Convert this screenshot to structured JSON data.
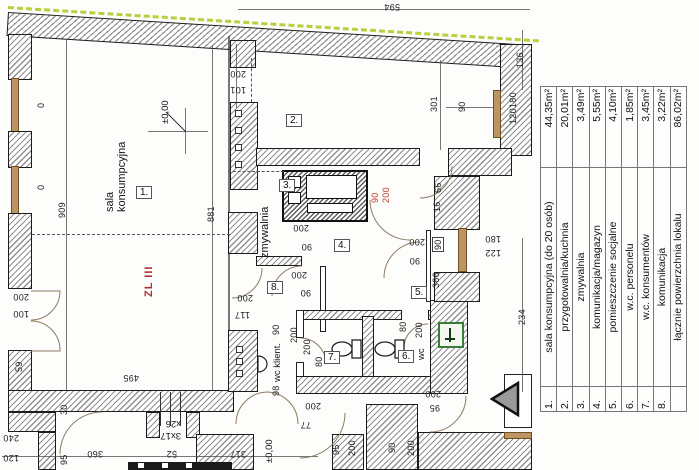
{
  "colors": {
    "boundary_cyan": "#35bfdc",
    "boundary_green": "#b9cf3e",
    "new_element_red": "#c03b2d",
    "window_tan": "#bd9466"
  },
  "legend": {
    "rows": [
      {
        "no": "1.",
        "name": "sala konsumpcyjna (do 20 osób)",
        "area": "44,35m²"
      },
      {
        "no": "2.",
        "name": "przygotowalnia/kuchnia",
        "area": "20,01m²"
      },
      {
        "no": "3.",
        "name": "zmywalnia",
        "area": "3,49m²"
      },
      {
        "no": "4.",
        "name": "komunikacja/magazyn",
        "area": "5,55m²"
      },
      {
        "no": "5.",
        "name": "pomieszczenie socjalne",
        "area": "4,10m²"
      },
      {
        "no": "6.",
        "name": "w.c. personelu",
        "area": "1,85m²"
      },
      {
        "no": "7.",
        "name": "w.c. konsumentów",
        "area": "3,45m²"
      },
      {
        "no": "8.",
        "name": "komunikacja",
        "area": "3,22m²"
      },
      {
        "no": "",
        "name": "łącznie powierzchnia lokalu",
        "area": "86,02m²"
      }
    ]
  },
  "room_numbers": [
    {
      "no": "1.",
      "x": 136,
      "y": 186
    },
    {
      "no": "2.",
      "x": 286,
      "y": 114
    },
    {
      "no": "3.",
      "x": 279,
      "y": 179
    },
    {
      "no": "4.",
      "x": 334,
      "y": 239
    },
    {
      "no": "5.",
      "x": 411,
      "y": 286
    },
    {
      "no": "6.",
      "x": 398,
      "y": 350
    },
    {
      "no": "7.",
      "x": 324,
      "y": 351
    },
    {
      "no": "8.",
      "x": 267,
      "y": 281
    }
  ],
  "texts": [
    {
      "t": "sala\nkonsumpcyjna",
      "x": 104,
      "y": 212,
      "r": -90,
      "c": "room"
    },
    {
      "t": "zmywalnia",
      "x": 259,
      "y": 258,
      "r": -90,
      "c": "room"
    },
    {
      "t": "wc",
      "x": 416,
      "y": 360,
      "r": -90,
      "c": "small"
    },
    {
      "t": "wc klient.",
      "x": 272,
      "y": 382,
      "r": -90,
      "c": "small"
    },
    {
      "t": "ZL III",
      "x": 143,
      "y": 297,
      "r": -90,
      "c": "fire"
    },
    {
      "t": "±0,00",
      "x": 160,
      "y": 124,
      "r": -90,
      "c": "small"
    },
    {
      "t": "±0,00",
      "x": 264,
      "y": 463,
      "r": -90,
      "c": "small"
    },
    {
      "t": "x26",
      "x": 181,
      "y": 429,
      "r": 180,
      "c": "small"
    },
    {
      "t": "3x17",
      "x": 181,
      "y": 441,
      "r": 180,
      "c": "small"
    }
  ],
  "dims": [
    {
      "t": "594",
      "x": 400,
      "y": 12,
      "r": 180
    },
    {
      "t": "200",
      "x": 246,
      "y": 79,
      "r": 180
    },
    {
      "t": "101",
      "x": 246,
      "y": 95,
      "r": 180
    },
    {
      "t": "909",
      "x": 57,
      "y": 218,
      "r": -90
    },
    {
      "t": "881",
      "x": 206,
      "y": 222,
      "r": -90
    },
    {
      "t": "0",
      "x": 36,
      "y": 108,
      "r": -90
    },
    {
      "t": "0",
      "x": 36,
      "y": 190,
      "r": -90
    },
    {
      "t": "200",
      "x": 29,
      "y": 302,
      "r": 180
    },
    {
      "t": "100",
      "x": 29,
      "y": 319,
      "r": 180
    },
    {
      "t": "59",
      "x": 14,
      "y": 372,
      "r": -90
    },
    {
      "t": "495",
      "x": 139,
      "y": 383,
      "r": 180
    },
    {
      "t": "200",
      "x": 253,
      "y": 303,
      "r": 180
    },
    {
      "t": "117",
      "x": 250,
      "y": 320,
      "r": 180
    },
    {
      "t": "200",
      "x": 309,
      "y": 233,
      "r": 180
    },
    {
      "t": "90",
      "x": 312,
      "y": 252,
      "r": 180
    },
    {
      "t": "200",
      "x": 307,
      "y": 280,
      "r": 180
    },
    {
      "t": "90",
      "x": 311,
      "y": 298,
      "r": 180
    },
    {
      "t": "90",
      "x": 370,
      "y": 203,
      "r": -90,
      "c": "red"
    },
    {
      "t": "200",
      "x": 381,
      "y": 203,
      "r": -90,
      "c": "red"
    },
    {
      "t": "301",
      "x": 429,
      "y": 112,
      "r": -90
    },
    {
      "t": "90",
      "x": 457,
      "y": 112,
      "r": -90
    },
    {
      "t": "136",
      "x": 515,
      "y": 68,
      "r": -90
    },
    {
      "t": "180",
      "x": 508,
      "y": 108,
      "r": -90
    },
    {
      "t": "120",
      "x": 508,
      "y": 124,
      "r": -90
    },
    {
      "t": "66",
      "x": 433,
      "y": 193,
      "r": -90
    },
    {
      "t": "16",
      "x": 432,
      "y": 212,
      "r": -90
    },
    {
      "t": "180",
      "x": 501,
      "y": 244,
      "r": 180
    },
    {
      "t": "122",
      "x": 501,
      "y": 258,
      "r": 180
    },
    {
      "t": "366",
      "x": 431,
      "y": 288,
      "r": -90
    },
    {
      "t": "234",
      "x": 517,
      "y": 325,
      "r": -90
    },
    {
      "t": "200",
      "x": 425,
      "y": 247,
      "r": 180
    },
    {
      "t": "90",
      "x": 432,
      "y": 252,
      "r": -90,
      "c": "box"
    },
    {
      "t": "90",
      "x": 420,
      "y": 266,
      "r": 180
    },
    {
      "t": "80",
      "x": 398,
      "y": 332,
      "r": -90
    },
    {
      "t": "200",
      "x": 414,
      "y": 338,
      "r": -90
    },
    {
      "t": "200",
      "x": 302,
      "y": 355,
      "r": -90
    },
    {
      "t": "80",
      "x": 314,
      "y": 367,
      "r": -90
    },
    {
      "t": "90",
      "x": 271,
      "y": 335,
      "r": -90
    },
    {
      "t": "200",
      "x": 289,
      "y": 343,
      "r": -90
    },
    {
      "t": "98",
      "x": 271,
      "y": 396,
      "r": -90
    },
    {
      "t": "30",
      "x": 59,
      "y": 415,
      "r": -90
    },
    {
      "t": "240",
      "x": 19,
      "y": 443,
      "r": 180
    },
    {
      "t": "120",
      "x": 19,
      "y": 463,
      "r": 180
    },
    {
      "t": "95",
      "x": 59,
      "y": 465,
      "r": -90
    },
    {
      "t": "360",
      "x": 103,
      "y": 459,
      "r": 180
    },
    {
      "t": "52",
      "x": 177,
      "y": 459,
      "r": 180
    },
    {
      "t": "317",
      "x": 246,
      "y": 459,
      "r": 180
    },
    {
      "t": "77",
      "x": 311,
      "y": 430,
      "r": 180
    },
    {
      "t": "95",
      "x": 331,
      "y": 455,
      "r": -90
    },
    {
      "t": "200",
      "x": 347,
      "y": 456,
      "r": -90
    },
    {
      "t": "90",
      "x": 387,
      "y": 453,
      "r": -90
    },
    {
      "t": "200",
      "x": 406,
      "y": 456,
      "r": -90
    },
    {
      "t": "200",
      "x": 321,
      "y": 411,
      "r": 180
    },
    {
      "t": "200",
      "x": 441,
      "y": 399,
      "r": 180
    },
    {
      "t": "95",
      "x": 440,
      "y": 413,
      "r": 180
    }
  ]
}
